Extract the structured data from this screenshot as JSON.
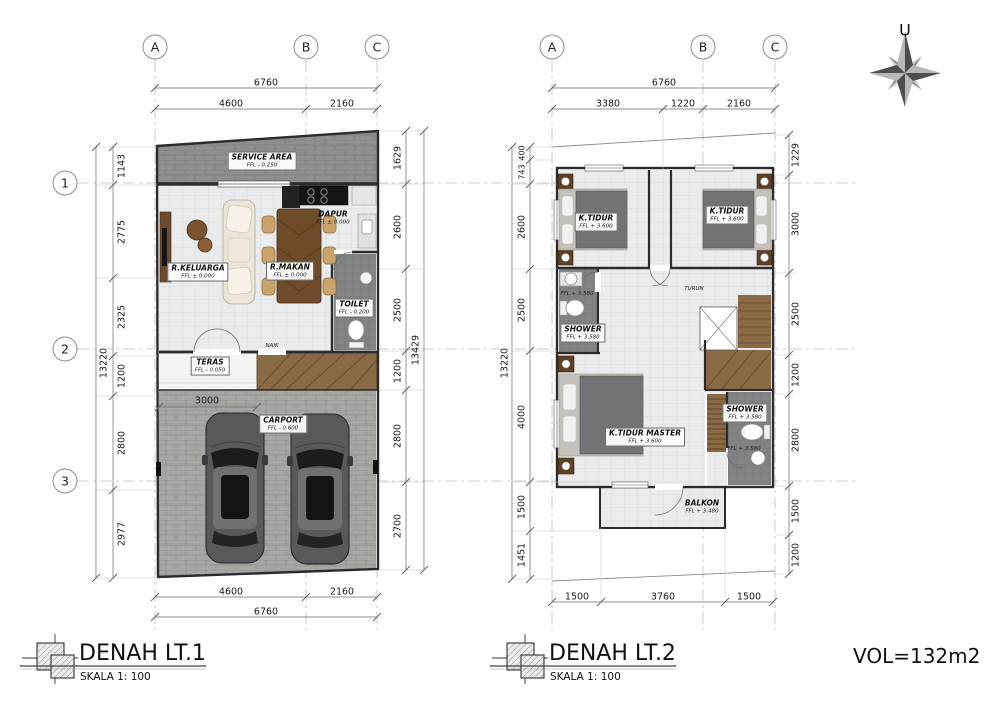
{
  "meta": {
    "north_label": "U",
    "volume": "VOL=132m2"
  },
  "colors": {
    "wall": "#2b2b2b",
    "floor_tile": "#e9ebec",
    "wet_floor": "#808284",
    "brick": "#8f8f8d",
    "paving": "#a6a6a3",
    "wood": "#8a6a45",
    "dim_text": "#1a1a1a"
  },
  "plan1": {
    "title": "DENAH LT.1",
    "scale": "SKALA 1: 100",
    "grid": {
      "cols": [
        "A",
        "B",
        "C"
      ],
      "rows": [
        "1",
        "2",
        "3"
      ]
    },
    "dims": {
      "top_overall": "6760",
      "top": [
        "4600",
        "2160"
      ],
      "bottom": [
        "4600",
        "2160"
      ],
      "bottom_overall": "6760",
      "left": [
        "1143",
        "2775",
        "2325",
        "1200",
        "2800",
        "2977"
      ],
      "left_overall": "13220",
      "right": [
        "1629",
        "2600",
        "2500",
        "1200",
        "2800",
        "2700"
      ],
      "right_overall": "13429",
      "interior": "3000"
    },
    "rooms": [
      {
        "name": "SERVICE AREA",
        "ffl": "FFL - 0.250"
      },
      {
        "name": "DAPUR",
        "ffl": "FFL ± 0.000"
      },
      {
        "name": "R.KELUARGA",
        "ffl": "FFL ± 0.000"
      },
      {
        "name": "R.MAKAN",
        "ffl": "FFL ± 0.000"
      },
      {
        "name": "TOILET",
        "ffl": "FFL - 0.200"
      },
      {
        "name": "TERAS",
        "ffl": "FFL - 0.050"
      },
      {
        "name": "CARPORT",
        "ffl": "FFL - 0.600"
      }
    ],
    "annotations": {
      "stair": "NAIK"
    }
  },
  "plan2": {
    "title": "DENAH LT.2",
    "scale": "SKALA 1: 100",
    "grid": {
      "cols": [
        "A",
        "B",
        "C"
      ]
    },
    "dims": {
      "top_overall": "6760",
      "top": [
        "3380",
        "1220",
        "2160"
      ],
      "bottom": [
        "1500",
        "3760",
        "1500"
      ],
      "left": [
        "400",
        "743",
        "2600",
        "2500",
        "4000",
        "1500",
        "1451"
      ],
      "left_overall": "13220",
      "right": [
        "1229",
        "3000",
        "2500",
        "1200",
        "2800",
        "1500",
        "1200"
      ]
    },
    "rooms": [
      {
        "name": "K.TIDUR",
        "ffl": "FFL + 3.600"
      },
      {
        "name": "K.TIDUR",
        "ffl": "FFL + 3.600"
      },
      {
        "name": "SHOWER",
        "ffl": "FFL + 3.580"
      },
      {
        "name": "K.TIDUR MASTER",
        "ffl": "FFL + 3.600"
      },
      {
        "name": "SHOWER",
        "ffl": "FFL + 3.580"
      },
      {
        "name": "BALKON",
        "ffl": "FFL + 3.480"
      }
    ],
    "extra_ffl": [
      "FFL + 3.580",
      "FFL + 3.580"
    ],
    "annotations": {
      "stair": "TURUN"
    }
  }
}
